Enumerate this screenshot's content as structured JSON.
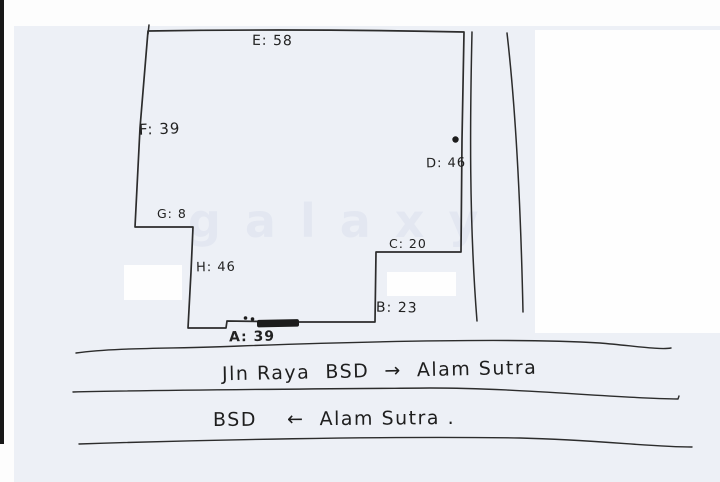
{
  "plot": {
    "side_labels": [
      {
        "side": "A",
        "value": "39",
        "text": "A: 39"
      },
      {
        "side": "B",
        "value": "23",
        "text": "B: 23"
      },
      {
        "side": "C",
        "value": "20",
        "text": "C: 20"
      },
      {
        "side": "D",
        "value": "46",
        "text": "D: 46"
      },
      {
        "side": "E",
        "value": "58",
        "text": "E: 58"
      },
      {
        "side": "F",
        "value": "39",
        "text": "F: 39"
      },
      {
        "side": "G",
        "value": "8",
        "text": "G: 8"
      },
      {
        "side": "H",
        "value": "46",
        "text": "H: 46"
      }
    ]
  },
  "roads": {
    "label_top": "Jln Raya  BSD  →  Alam Sutra",
    "label_bottom": "BSD    ←  Alam Sutra ."
  },
  "watermark": {
    "text": "galaxy"
  },
  "colors": {
    "ink": "#2c2c2c",
    "paper": "#edf0f6",
    "page_edge": "#181818",
    "whiteout": "#fefefe"
  }
}
